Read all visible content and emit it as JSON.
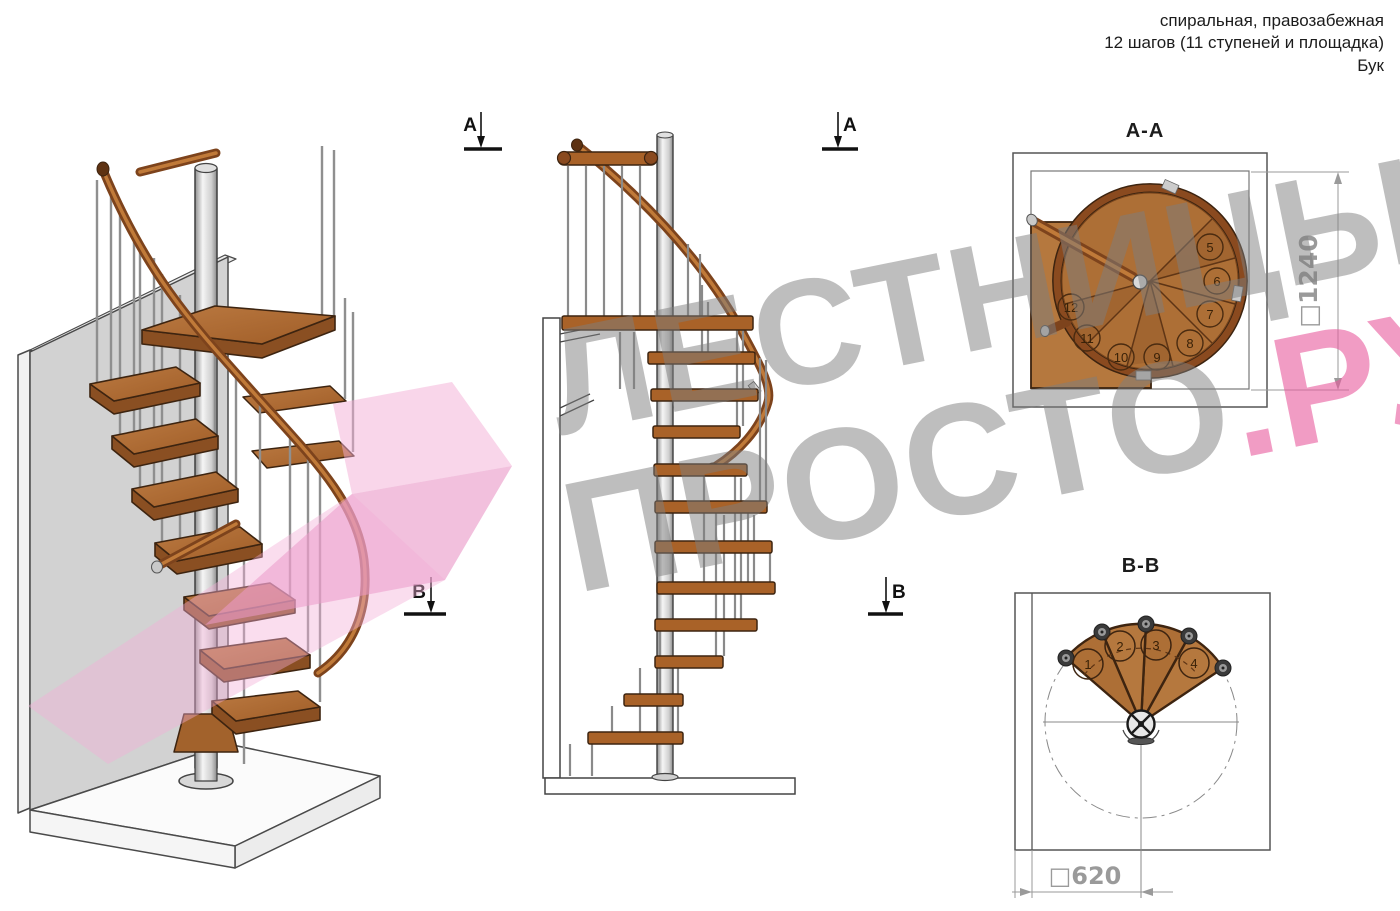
{
  "header": {
    "line1": "спиральная, правозабежная",
    "line2": "12 шагов (11 ступеней и площадка)",
    "line3": "Бук"
  },
  "section_markers": {
    "a": "A",
    "b": "B"
  },
  "views": {
    "aa": {
      "label": "A-A",
      "dimension": "□1240",
      "step_numbers": [
        "5",
        "6",
        "7",
        "8",
        "9",
        "10",
        "11",
        "12"
      ]
    },
    "bb": {
      "label": "B-B",
      "dimension": "□620",
      "step_numbers": [
        "1",
        "2",
        "3",
        "4"
      ]
    }
  },
  "watermark": {
    "line1": "ЛЕСТНИЦЫ",
    "line2": "ПРОСТО",
    "suffix": ".РУ"
  },
  "colors": {
    "watermark_pink": "#e85a9d",
    "watermark_gray": "#7d7d7d",
    "wood": "#b06a33",
    "wood_dark": "#8a4f22",
    "rail_brown": "#7d431c",
    "metal_light": "#f2f2f2",
    "metal_dark": "#8f8f8f",
    "wall_gray": "#d2d2d2",
    "dimension_gray": "#9a9a9a"
  }
}
